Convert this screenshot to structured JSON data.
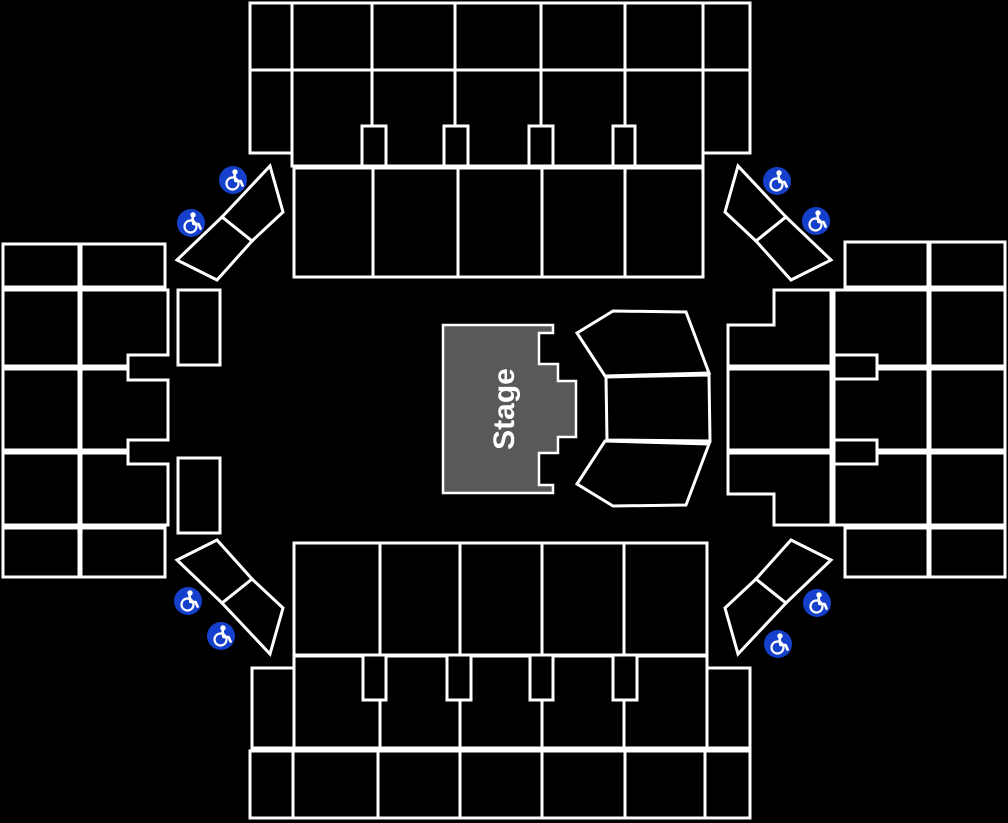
{
  "page": {
    "background_color": "#000000",
    "type": "venue-seating-map"
  },
  "stage": {
    "label": "Stage"
  },
  "colors": {
    "outline": "#ffffff",
    "section_fill": "#000000",
    "stage_fill": "#59595b",
    "stage_text": "#ffffff",
    "accessible_blue": "#1540cc"
  },
  "icons": {
    "wheelchair_icon_symbol": "wheelchair-accessible",
    "count": 8,
    "positions": [
      "translate(233,180)",
      "translate(191,223)",
      "translate(777,181)",
      "translate(816,221)",
      "translate(188,601)",
      "translate(221,636)",
      "translate(817,603)",
      "translate(778,644)"
    ]
  }
}
